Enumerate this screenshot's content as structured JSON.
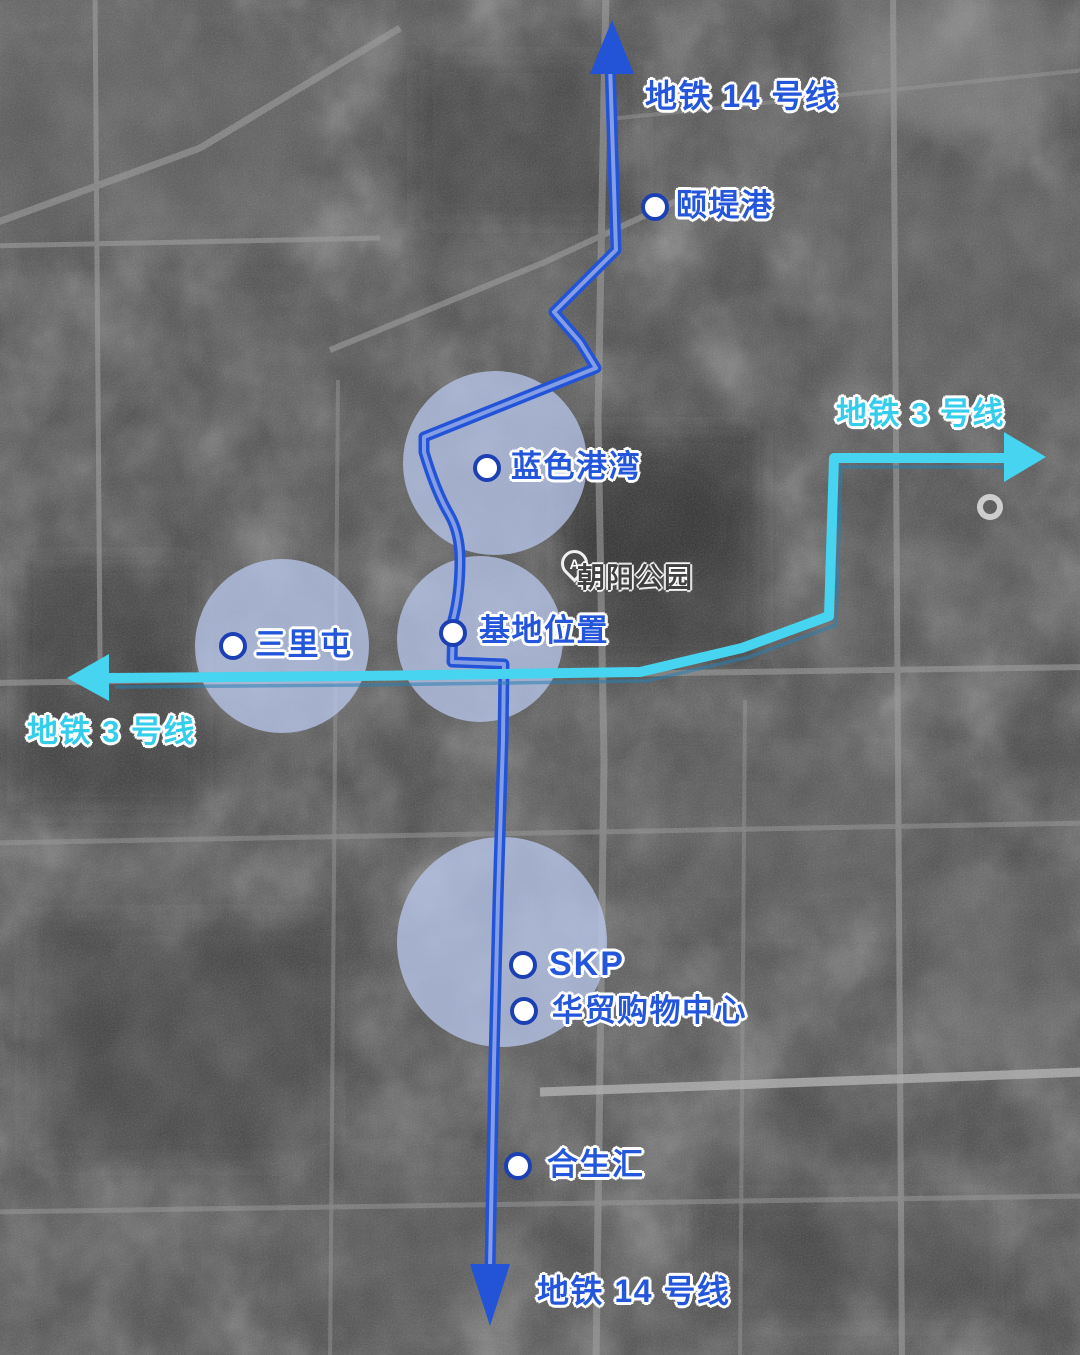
{
  "map": {
    "type": "satellite-grayscale",
    "colors": {
      "line14_blue": "#2353d6",
      "line3_cyan": "#46d4f0",
      "station_label_blue": "#2456dc",
      "line3_label_cyan": "#35cdec",
      "station_dot_ring": "#1c40b4",
      "highlight_circle": "#bac9f0",
      "park_label_gray": "#404040"
    },
    "labels": {
      "line14_top": "地铁 14 号线",
      "line14_bottom": "地铁 14 号线",
      "line3_right": "地铁 3 号线",
      "line3_left": "地铁 3 号线",
      "park": "朝阳公园",
      "park_pin": "A"
    },
    "stations": [
      {
        "name": "颐堤港"
      },
      {
        "name": "蓝色港湾"
      },
      {
        "name": "基地位置"
      },
      {
        "name": "三里屯"
      },
      {
        "name": "SKP"
      },
      {
        "name": "华贸购物中心"
      },
      {
        "name": "合生汇"
      }
    ],
    "metro_lines": [
      {
        "id": "line14",
        "name": "地铁 14 号线",
        "color": "#2353d6",
        "direction_arrows": [
          "up",
          "down"
        ]
      },
      {
        "id": "line3",
        "name": "地铁 3 号线",
        "color": "#46d4f0",
        "direction_arrows": [
          "left",
          "right"
        ]
      }
    ]
  }
}
